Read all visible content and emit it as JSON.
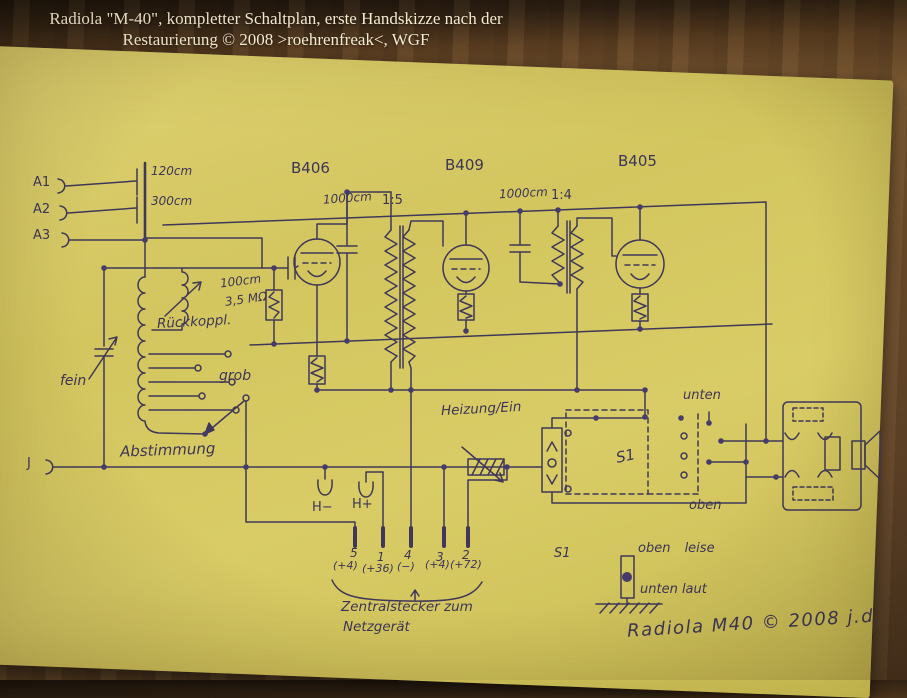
{
  "caption": {
    "line1": "Radiola \"M-40\", kompletter Schaltplan, erste Handskizze nach der",
    "line2": "Restaurierung © 2008 >roehrenfreak<, WGF"
  },
  "schematic": {
    "ink_color": "#3d3557",
    "paper_color": "#d5c862",
    "tubes": [
      "B406",
      "B409",
      "B405"
    ],
    "transformer_ratios": [
      "1:5",
      "1:4"
    ],
    "labels": {
      "a1": "A1",
      "a2": "A2",
      "a3": "A3",
      "c120": "120cm",
      "c300": "300cm",
      "b406": "B406",
      "b409": "B409",
      "b405": "B405",
      "c1000_1": "1000cm",
      "ratio15": "1:5",
      "c1000_2": "1000cm",
      "ratio14": "1:4",
      "c100": "100cm",
      "r35": "3,5 MΩ",
      "rueckkoppl": "Rückkoppl.",
      "fein": "fein",
      "grob": "grob",
      "abstimmung": "Abstimmung",
      "heizung": "Heizung/Ein",
      "j": "J",
      "h_minus": "H−",
      "h_plus": "H+",
      "pin5": "5",
      "pin1": "1",
      "pin4": "4",
      "pin3": "3",
      "pin2": "2",
      "v5": "(+4)",
      "v1": "(+36)",
      "v4": "(−)",
      "v3": "(+4)",
      "v2": "(+72)",
      "zentral1": "Zentralstecker zum",
      "zentral2": "Netzgerät",
      "s1_legend": "S1",
      "oben_leise": "oben leise",
      "unten_laut": "unten laut",
      "s1_switch": "S1",
      "unten": "unten",
      "oben": "oben",
      "signature": "Radiola M40 © 2008 j.d."
    }
  }
}
